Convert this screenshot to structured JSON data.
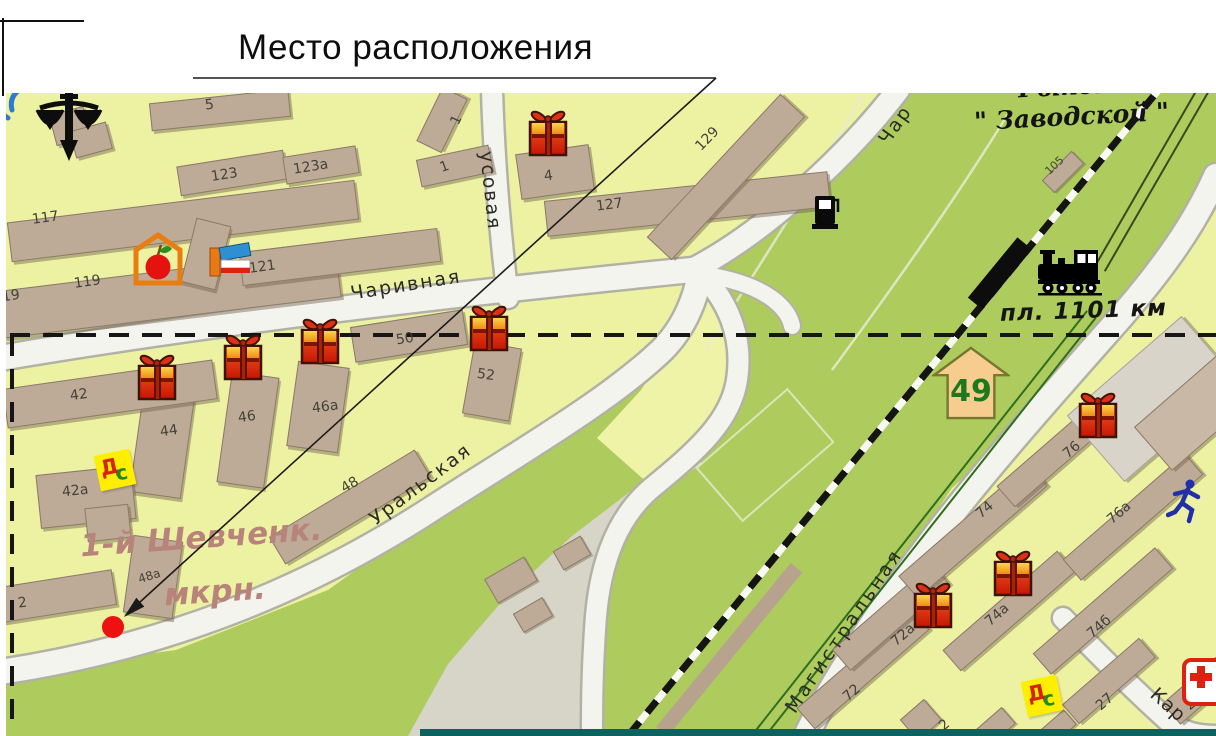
{
  "title": "Место расположения",
  "map": {
    "district": {
      "line1": "1-й Шевченк.",
      "line2": "мкрн."
    },
    "area": {
      "line1": "Рынок",
      "line2": "\" Заводской \""
    },
    "railway": {
      "platform": "пл. 1101 км"
    },
    "route_arrow": "49",
    "streets": {
      "charivnaya": "Чаривная",
      "charivnaya_cut": "Чар",
      "usovaya": "усовая",
      "uralskaya": "Уральская",
      "magistralnaya": "Магистральная",
      "kar_cut": "Кар"
    },
    "kindergarten": {
      "d": "Д",
      "s": "с"
    },
    "building_labels": [
      "117",
      "119",
      "19",
      "121",
      "123",
      "123а",
      "1",
      "1",
      "5",
      "127",
      "129",
      "4",
      "105",
      "50",
      "52",
      "42",
      "44",
      "46",
      "46а",
      "48",
      "42а",
      "48а",
      "2",
      "72",
      "72а",
      "74",
      "74а",
      "74б",
      "76",
      "76а",
      "27",
      "21а",
      "2"
    ],
    "colors": {
      "block_yellow": "#edf2a3",
      "greenery": "#aecb5d",
      "road_fill": "#f4f4ee",
      "building_tan": "#beab97",
      "marker_red": "#ee1111",
      "district_text": "#b8837a",
      "arrow_sign_fill": "#f6cd8e",
      "arrow_sign_text": "#1c7a1c"
    },
    "icons": [
      "scales-of-justice-icon",
      "produce-market-icon",
      "books-icon",
      "kindergarten-icon",
      "gas-station-icon",
      "train-icon",
      "gift-icon",
      "runner-icon",
      "medical-cross-icon",
      "route-arrow-sign",
      "location-marker"
    ]
  }
}
